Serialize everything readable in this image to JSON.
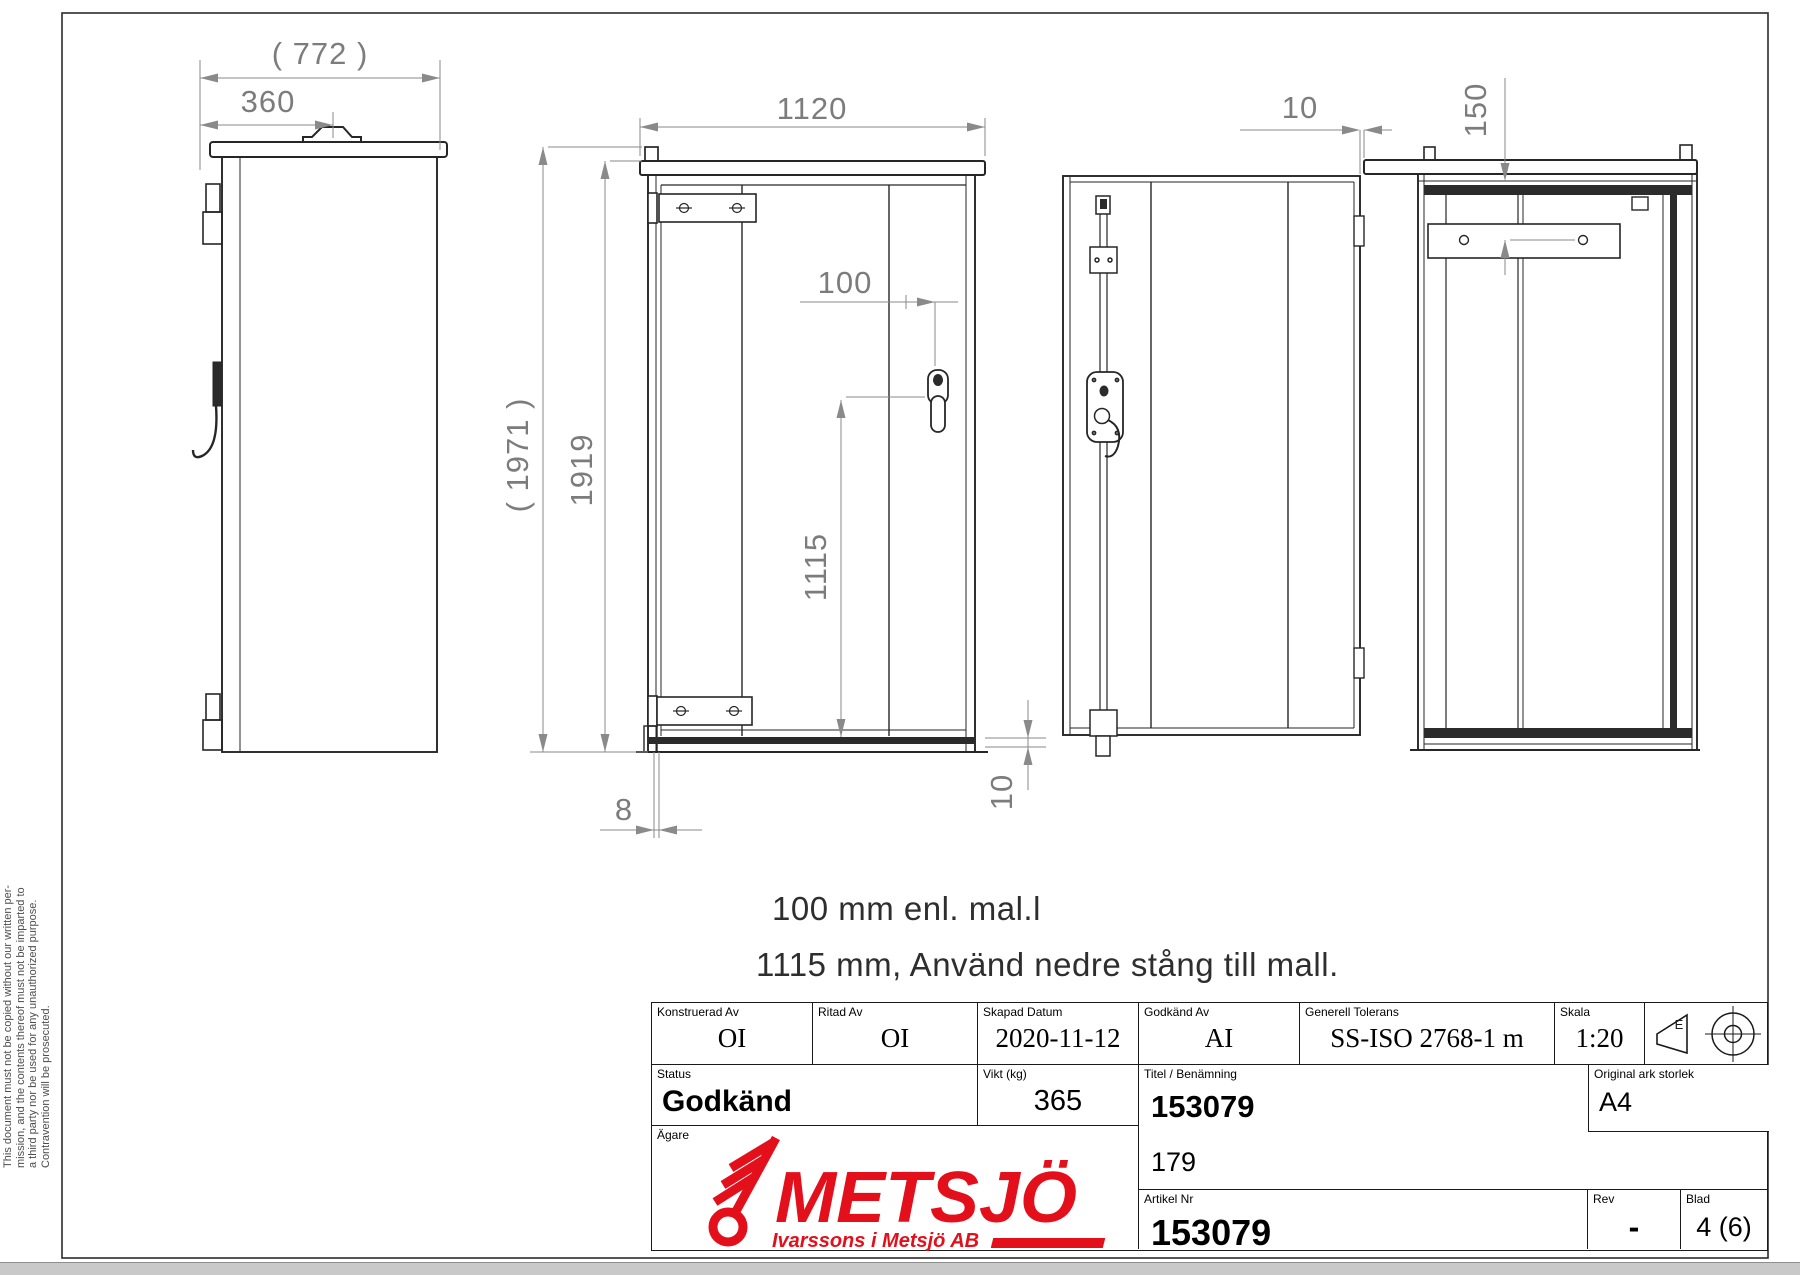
{
  "dims": {
    "side_total_width": "( 772 )",
    "side_handle_x": "360",
    "front_width": "1120",
    "total_height": "( 1971 )",
    "body_height": "1919",
    "handle_offset": "100",
    "rod_to_bottom": "1115",
    "door_bottom_gap": "8",
    "sill_height": "10",
    "hinge_gap": "10",
    "plate_offset": "150"
  },
  "notes": {
    "line1": "100 mm enl. mal.l",
    "line2": "1115 mm, Använd nedre stång till mall."
  },
  "disclaimer": {
    "line1": "This document must not be copied without our written per-",
    "line2": "mission, and the contents thereof must not be imparted to",
    "line3": "a third party nor be used for any unauthorized purpose.",
    "line4": "Contravention will be prosecuted."
  },
  "title_block": {
    "konstruerad_label": "Konstruerad Av",
    "konstruerad_value": "OI",
    "ritad_label": "Ritad Av",
    "ritad_value": "OI",
    "skapad_label": "Skapad Datum",
    "skapad_value": "2020-11-12",
    "godkand_av_label": "Godkänd Av",
    "godkand_av_value": "AI",
    "tolerans_label": "Generell Tolerans",
    "tolerans_value": "SS-ISO 2768-1 m",
    "skala_label": "Skala",
    "skala_value": "1:20",
    "projection_letter": "E",
    "status_label": "Status",
    "status_value": "Godkänd",
    "vikt_label": "Vikt (kg)",
    "vikt_value": "365",
    "titel_label": "Titel / Benämning",
    "titel_value": "153079",
    "titel_value2": "179",
    "ark_label": "Original ark storlek",
    "ark_value": "A4",
    "agare_label": "Ägare",
    "artikel_label": "Artikel Nr",
    "artikel_value": "153079",
    "rev_label": "Rev",
    "rev_value": "-",
    "blad_label": "Blad",
    "blad_value": "4 (6)"
  },
  "logo": {
    "name": "METSJÖ",
    "subtitle": "Ivarssons i Metsjö AB",
    "color": "#e30f1b"
  }
}
